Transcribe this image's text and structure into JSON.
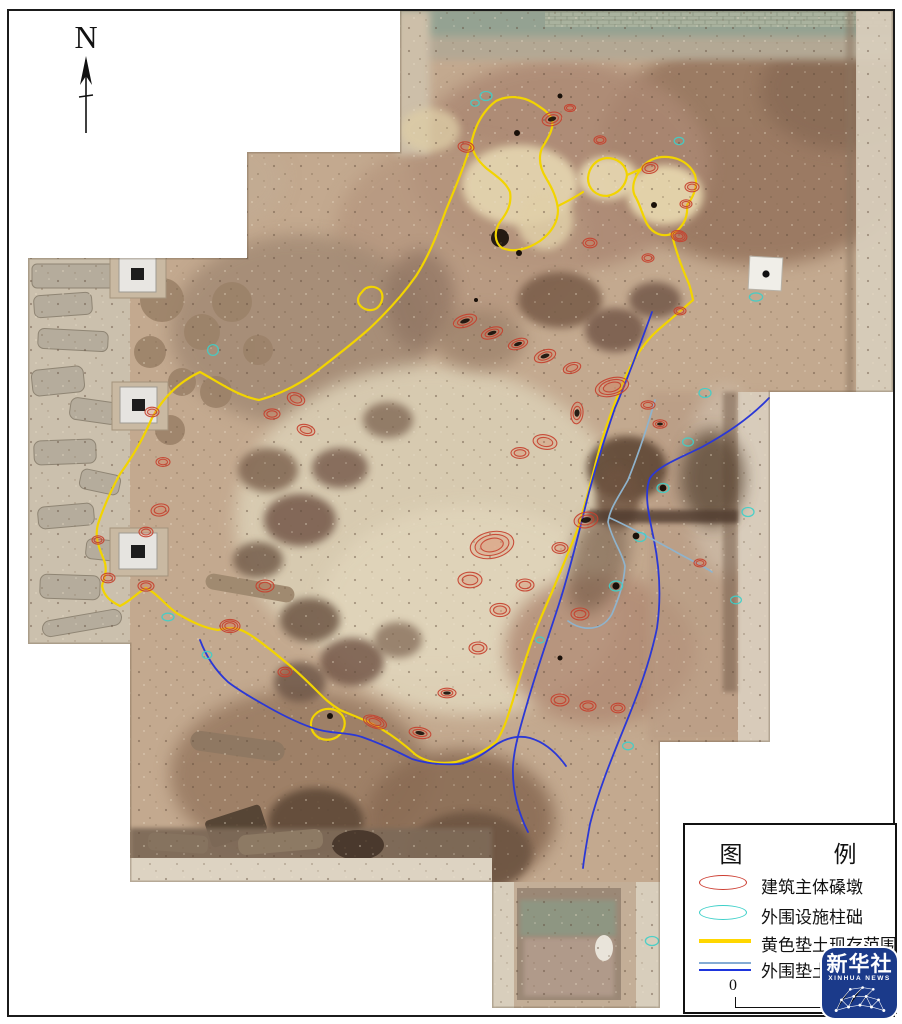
{
  "figure": {
    "type": "archaeological-excavation-orthophoto-plan",
    "north_label": "N"
  },
  "legend": {
    "title": "图　例",
    "items": [
      {
        "label": "建筑主体磉墩",
        "symbol": "red-ellipse",
        "color": "#cd3f33"
      },
      {
        "label": "外围设施柱础",
        "symbol": "cyan-ellipse",
        "color": "#3fd0c9"
      },
      {
        "label": "黄色垫土现存范围",
        "symbol": "yellow-line",
        "color": "#ffd700"
      },
      {
        "label": "外围垫土现",
        "symbol": "double-blue-line",
        "colors": [
          "#84abd4",
          "#1e35dd"
        ]
      }
    ],
    "scale_zero": "0"
  },
  "watermark": {
    "name": "新华社",
    "subtitle": "XINHUA NEWS",
    "background": "#1b3a8a"
  },
  "annotation_colors": {
    "pier_red": "#c6412e",
    "column_cyan": "#3fd0c9",
    "yellow_fill_boundary": "#f2d400",
    "outer_fill_blue": "#2b38d6",
    "outer_fill_lightblue": "#8fb3cc"
  }
}
